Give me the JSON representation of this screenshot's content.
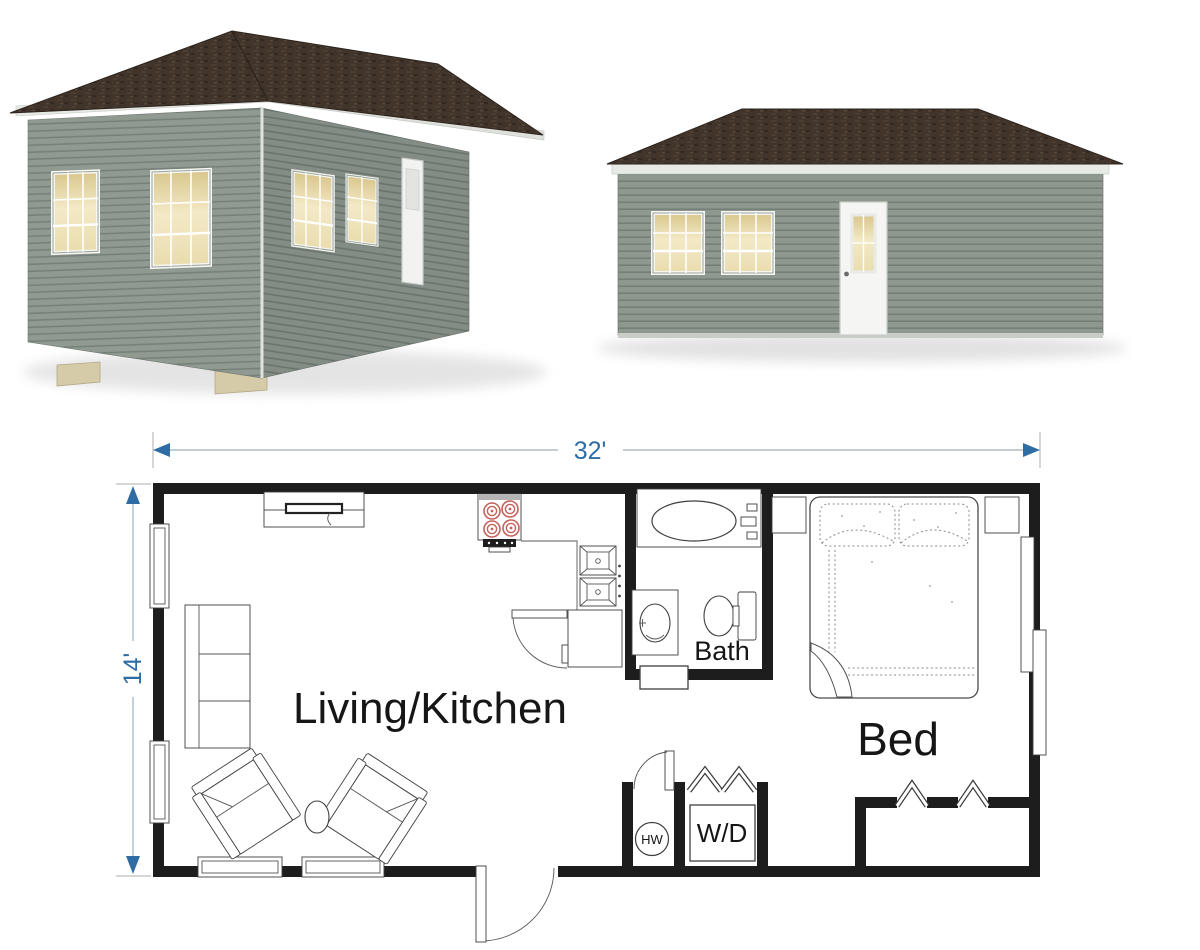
{
  "floor_plan": {
    "dimensions": {
      "width_label": "32'",
      "depth_label": "14'"
    },
    "rooms": {
      "living_kitchen": "Living/Kitchen",
      "bath": "Bath",
      "bed": "Bed"
    },
    "appliances": {
      "washer_dryer": "W/D",
      "water_heater": "HW"
    }
  },
  "colors": {
    "dimension_blue": "#2e6da4",
    "wall_black": "#1d1d1d",
    "roof_brown": "#41342a",
    "siding_gray": "#8f998f",
    "window_glow": "#efe3bb",
    "burner_red": "#c4625c"
  }
}
